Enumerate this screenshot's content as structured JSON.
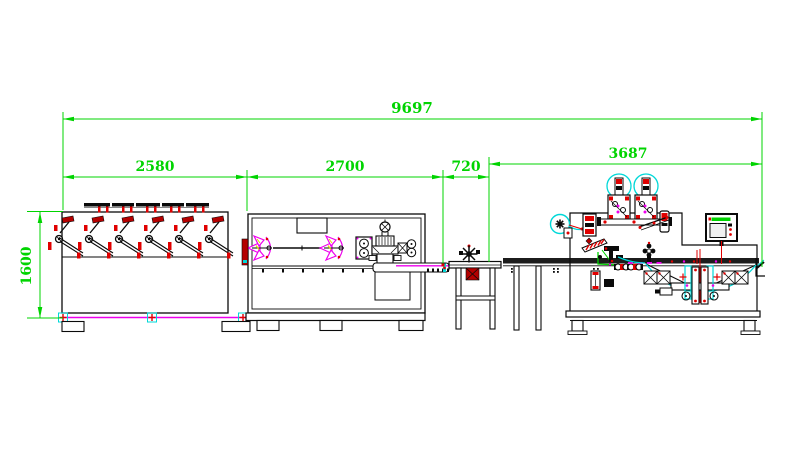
{
  "drawing": {
    "dimension_labels": {
      "overall": "9697",
      "section_unwinder": "2580",
      "section_forming": "2700",
      "section_transfer": "720",
      "section_packaging": "3687",
      "height": "1600"
    }
  },
  "colors": {
    "dimension": "#00d400",
    "outline": "#0a0a0a",
    "magenta": "#ee00ee",
    "red": "#e00000",
    "dark_red": "#b40000",
    "cyan": "#00d8d8",
    "yellow": "#e0d800",
    "background": "#ffffff"
  }
}
